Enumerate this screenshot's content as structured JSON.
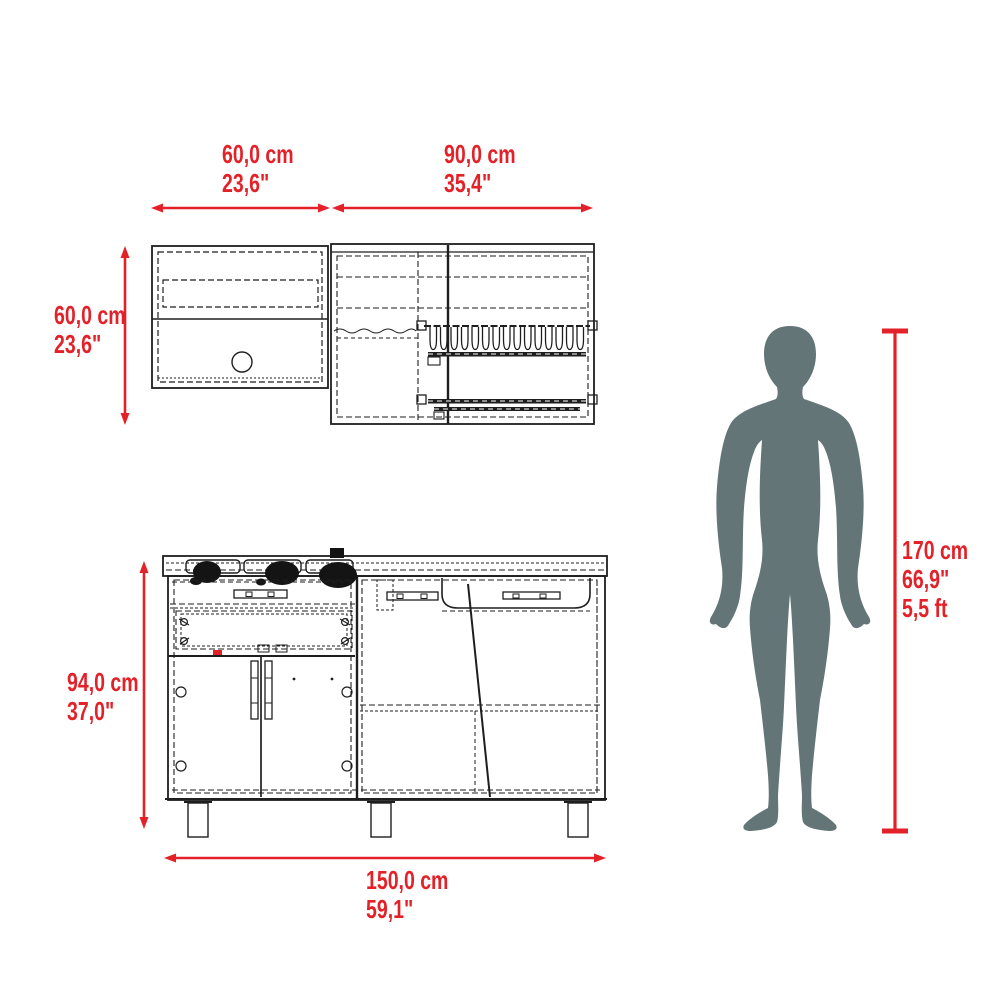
{
  "diagram_title": "kitchen-set-dimension-diagram",
  "colors": {
    "accent_red": "#e32128",
    "silhouette_gray": "#647578",
    "line_dark": "#1e1e1e"
  },
  "dims": {
    "upper_left_width": {
      "cm": "60,0 cm",
      "inch": "23,6\""
    },
    "upper_right_width": {
      "cm": "90,0 cm",
      "inch": "35,4\""
    },
    "upper_height": {
      "cm": "60,0 cm",
      "inch": "23,6\""
    },
    "base_height": {
      "cm": "94,0 cm",
      "inch": "37,0\""
    },
    "base_width": {
      "cm": "150,0 cm",
      "inch": "59,1\""
    },
    "person_height": {
      "cm": "170 cm",
      "inch": "66,9\"",
      "ft": "5,5 ft"
    }
  }
}
